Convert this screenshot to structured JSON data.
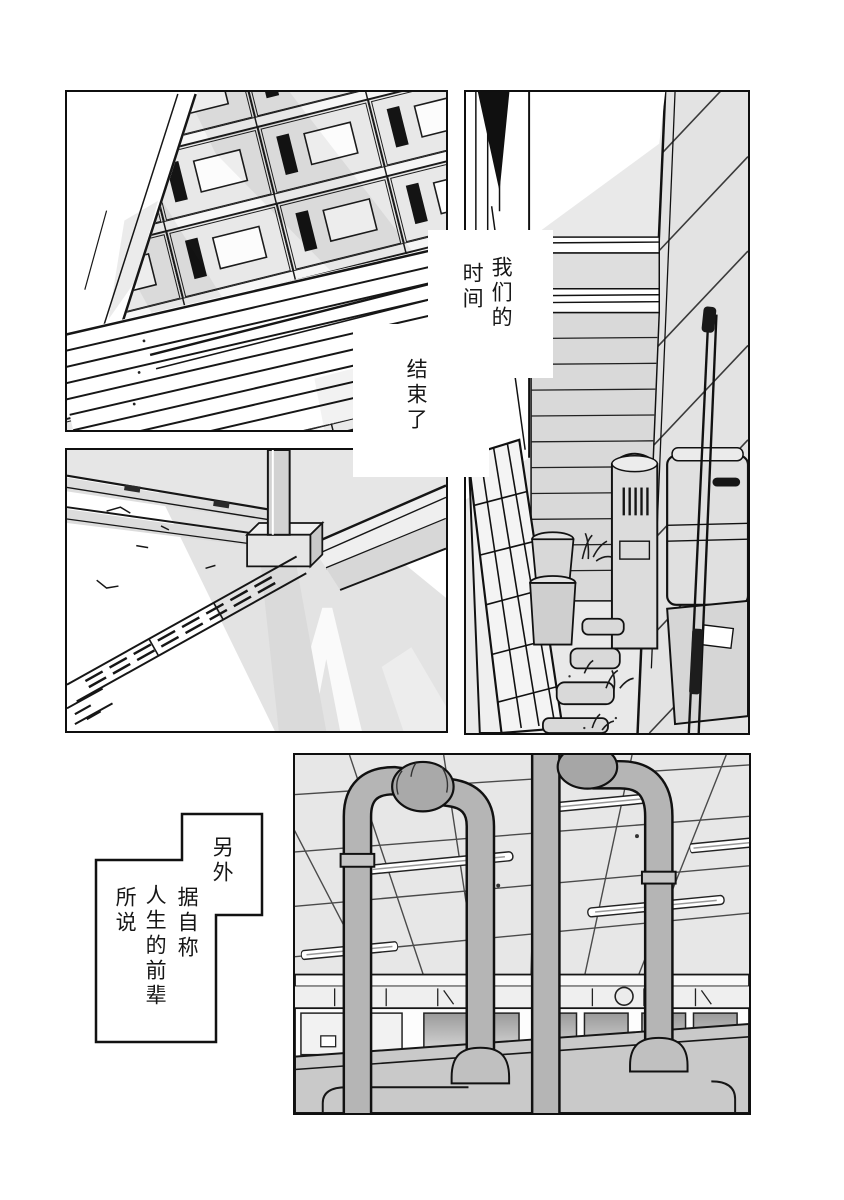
{
  "page": {
    "width": 844,
    "height": 1200,
    "background": "#ffffff"
  },
  "colors": {
    "ink": "#111111",
    "paper": "#ffffff",
    "tone_light": "#e9e9e9",
    "tone_mid": "#cccccc",
    "pipe_gray": "#b5b5b5"
  },
  "narration": {
    "box_top": {
      "col1": "我们的",
      "col2": "时间",
      "col3": "结束了"
    },
    "box_bottom": {
      "col1": "另外",
      "col2": "据自称",
      "col3": "人生的前辈",
      "col4": "所说"
    }
  }
}
